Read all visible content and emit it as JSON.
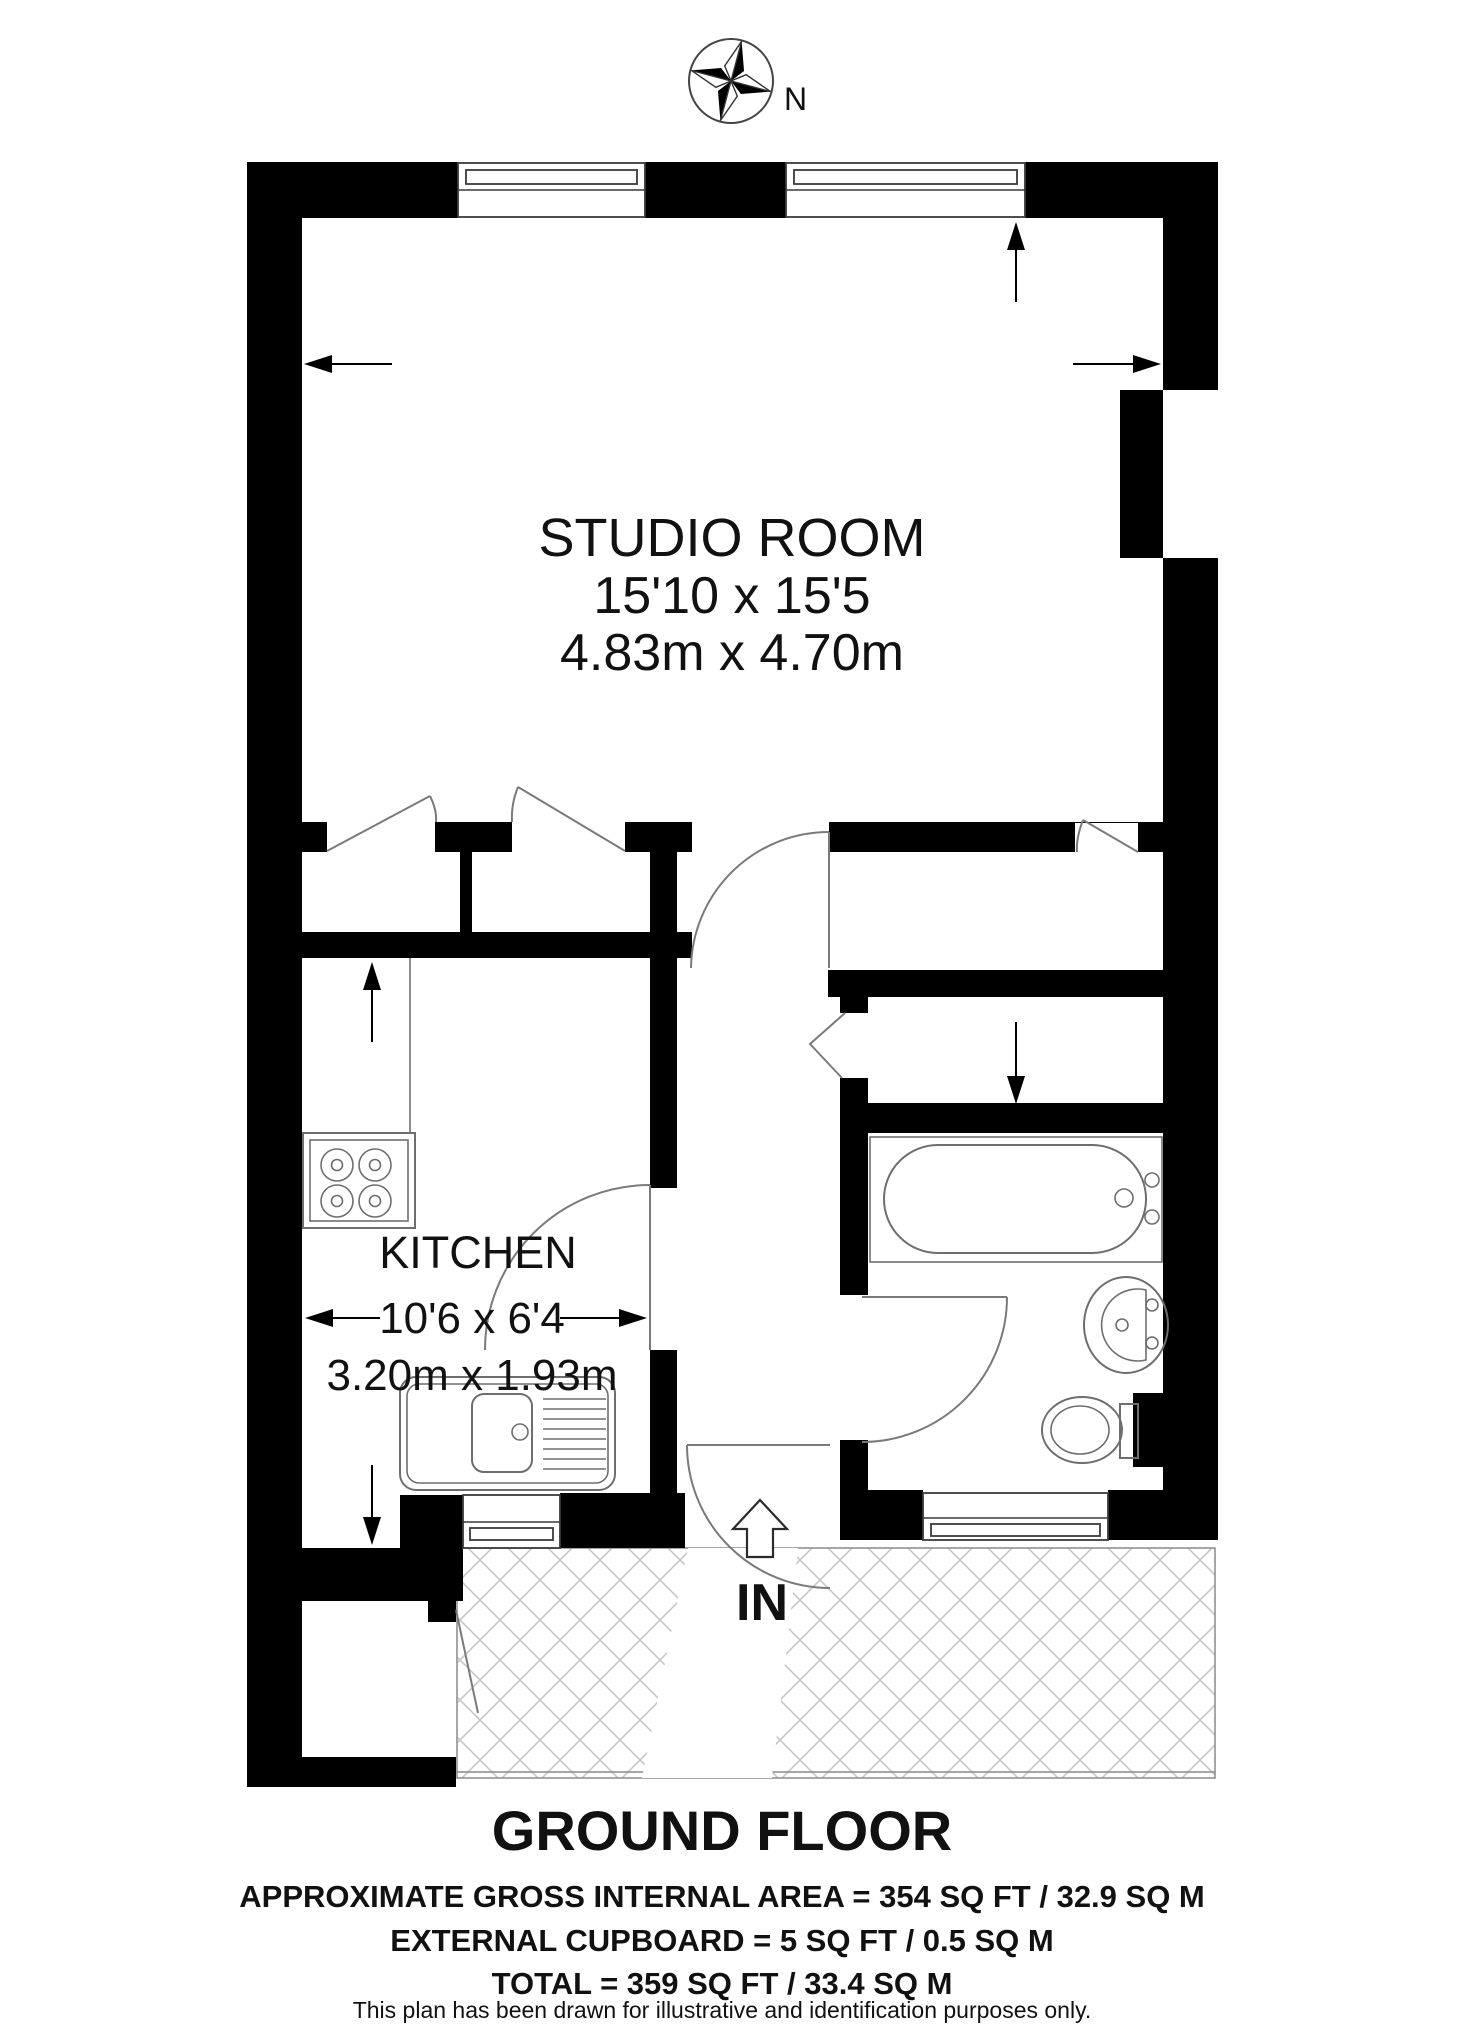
{
  "compass": {
    "label": "N"
  },
  "rooms": {
    "studio": {
      "name": "STUDIO ROOM",
      "dimensions_imperial": "15'10 x 15'5",
      "dimensions_metric": "4.83m x 4.70m"
    },
    "kitchen": {
      "name": "KITCHEN",
      "dimensions_imperial": "10'6 x 6'4",
      "dimensions_metric": "3.20m x 1.93m"
    }
  },
  "entrance": {
    "label": "IN"
  },
  "footer": {
    "floor_title": "GROUND FLOOR",
    "area_line_1": "APPROXIMATE GROSS INTERNAL AREA = 354 SQ FT / 32.9 SQ M",
    "area_line_2": "EXTERNAL CUPBOARD  = 5 SQ FT / 0.5 SQ M",
    "area_line_3": "TOTAL = 359 SQ FT / 33.4 SQ M",
    "disclaimer": "This plan has been drawn for illustrative and identification purposes only."
  },
  "colors": {
    "wall": "#000000",
    "fixture_line": "#6e6e6e",
    "hatch_line": "#c6c6c6",
    "text": "#111111"
  }
}
